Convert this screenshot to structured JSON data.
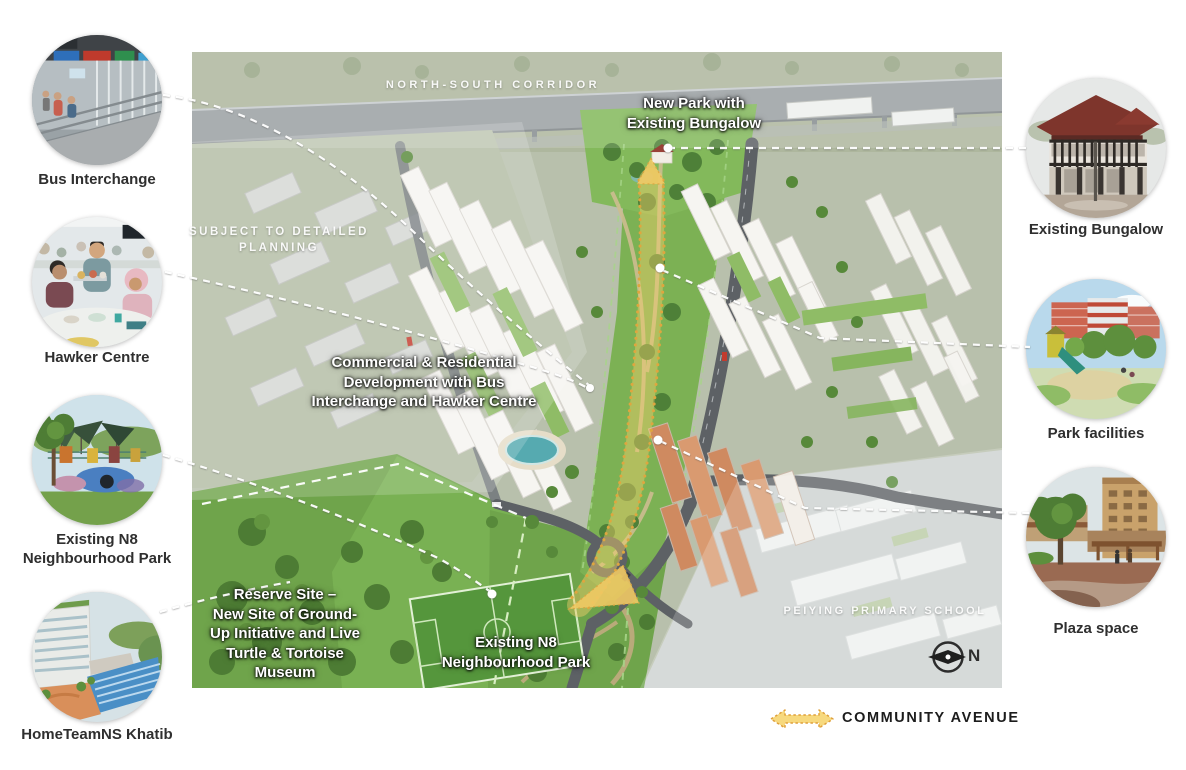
{
  "map": {
    "labels": {
      "north_south_corridor": "NORTH-SOUTH CORRIDOR",
      "new_park": "New Park with\nExisting Bungalow",
      "subject_to_planning": "SUBJECT TO DETAILED\nPLANNING",
      "commercial_residential": "Commercial & Residential\nDevelopment with Bus\nInterchange and Hawker Centre",
      "reserve_site": "Reserve Site –\nNew Site of Ground-\nUp Initiative and Live\nTurtle & Tortoise\nMuseum",
      "existing_n8_park": "Existing N8\nNeighbourhood Park",
      "peiying_school": "PEIYING PRIMARY SCHOOL"
    },
    "compass_label": "N"
  },
  "legend": {
    "community_avenue": "COMMUNITY AVENUE"
  },
  "callouts": {
    "left": [
      {
        "id": "bus-interchange",
        "label": "Bus Interchange"
      },
      {
        "id": "hawker-centre",
        "label": "Hawker Centre"
      },
      {
        "id": "existing-n8-park",
        "label": "Existing N8\nNeighbourhood Park"
      },
      {
        "id": "hometeamns-khatib",
        "label": "HomeTeamNS Khatib"
      }
    ],
    "right": [
      {
        "id": "existing-bungalow",
        "label": "Existing Bungalow"
      },
      {
        "id": "park-facilities",
        "label": "Park facilities"
      },
      {
        "id": "plaza-space",
        "label": "Plaza space"
      }
    ]
  },
  "colors": {
    "avenue_yellow": "#f2cf6b",
    "avenue_outline": "#dfa63f",
    "park_green": "#7cb154",
    "muted_sage": "#b8c0ac",
    "road_grey": "#5d6165",
    "pool_teal": "#56aab0"
  }
}
